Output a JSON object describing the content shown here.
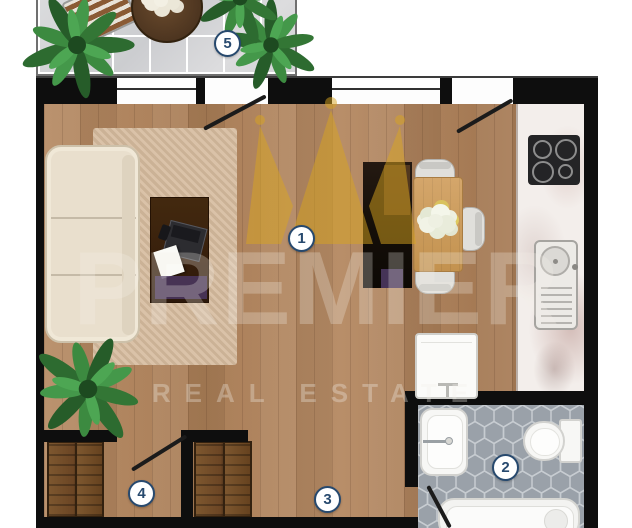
{
  "watermark": {
    "brand": "PREMIER",
    "tagline": "REAL ESTATE"
  },
  "labels": [
    {
      "num": "1",
      "room": "living-room"
    },
    {
      "num": "2",
      "room": "bathroom"
    },
    {
      "num": "3",
      "room": "hallway"
    },
    {
      "num": "4",
      "room": "wardrobe-room"
    },
    {
      "num": "5",
      "room": "balcony"
    }
  ],
  "colors": {
    "wall": "#0e0e0e",
    "label_text": "#27496e",
    "crown_gold": "#d9a51f",
    "wood_floor": "#b08764",
    "bathroom_tile": "#9aa1a9",
    "balcony_tile": "#d7d8da",
    "rug": "#d6bb9e",
    "sofa": "#e9dfcd"
  }
}
